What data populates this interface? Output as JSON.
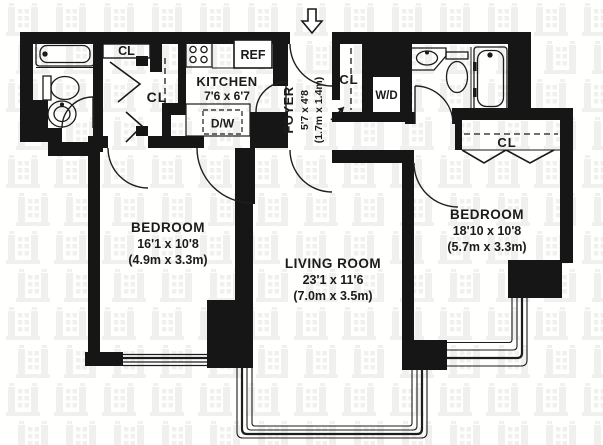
{
  "plan": {
    "title": "apartment-floor-plan",
    "rooms": {
      "bedroom1": {
        "name": "BEDROOM",
        "dims": "16'1 x 10'8",
        "metric": "(4.9m x 3.3m)"
      },
      "living": {
        "name": "LIVING ROOM",
        "dims": "23'1 x 11'6",
        "metric": "(7.0m x 3.5m)"
      },
      "bedroom2": {
        "name": "BEDROOM",
        "dims": "18'10 x 10'8",
        "metric": "(5.7m x 3.3m)"
      },
      "kitchen": {
        "name": "KITCHEN",
        "dims": "7'6 x 6'7"
      },
      "foyer": {
        "name": "FOYER",
        "dims": "5'7 x 4'8",
        "metric": "(1.7m x 1.4m)"
      }
    },
    "labels": {
      "closet_top": "CL",
      "closet_hall": "CL",
      "closet_entry": "CL",
      "closet_bedroom2": "CL",
      "refrigerator": "REF",
      "dishwasher": "D/W",
      "washer_dryer": "W/D"
    },
    "colors": {
      "wall": "#161616",
      "line": "#1a1a1a",
      "watermark": "#f0f0ee",
      "background": "#fffffe"
    }
  }
}
